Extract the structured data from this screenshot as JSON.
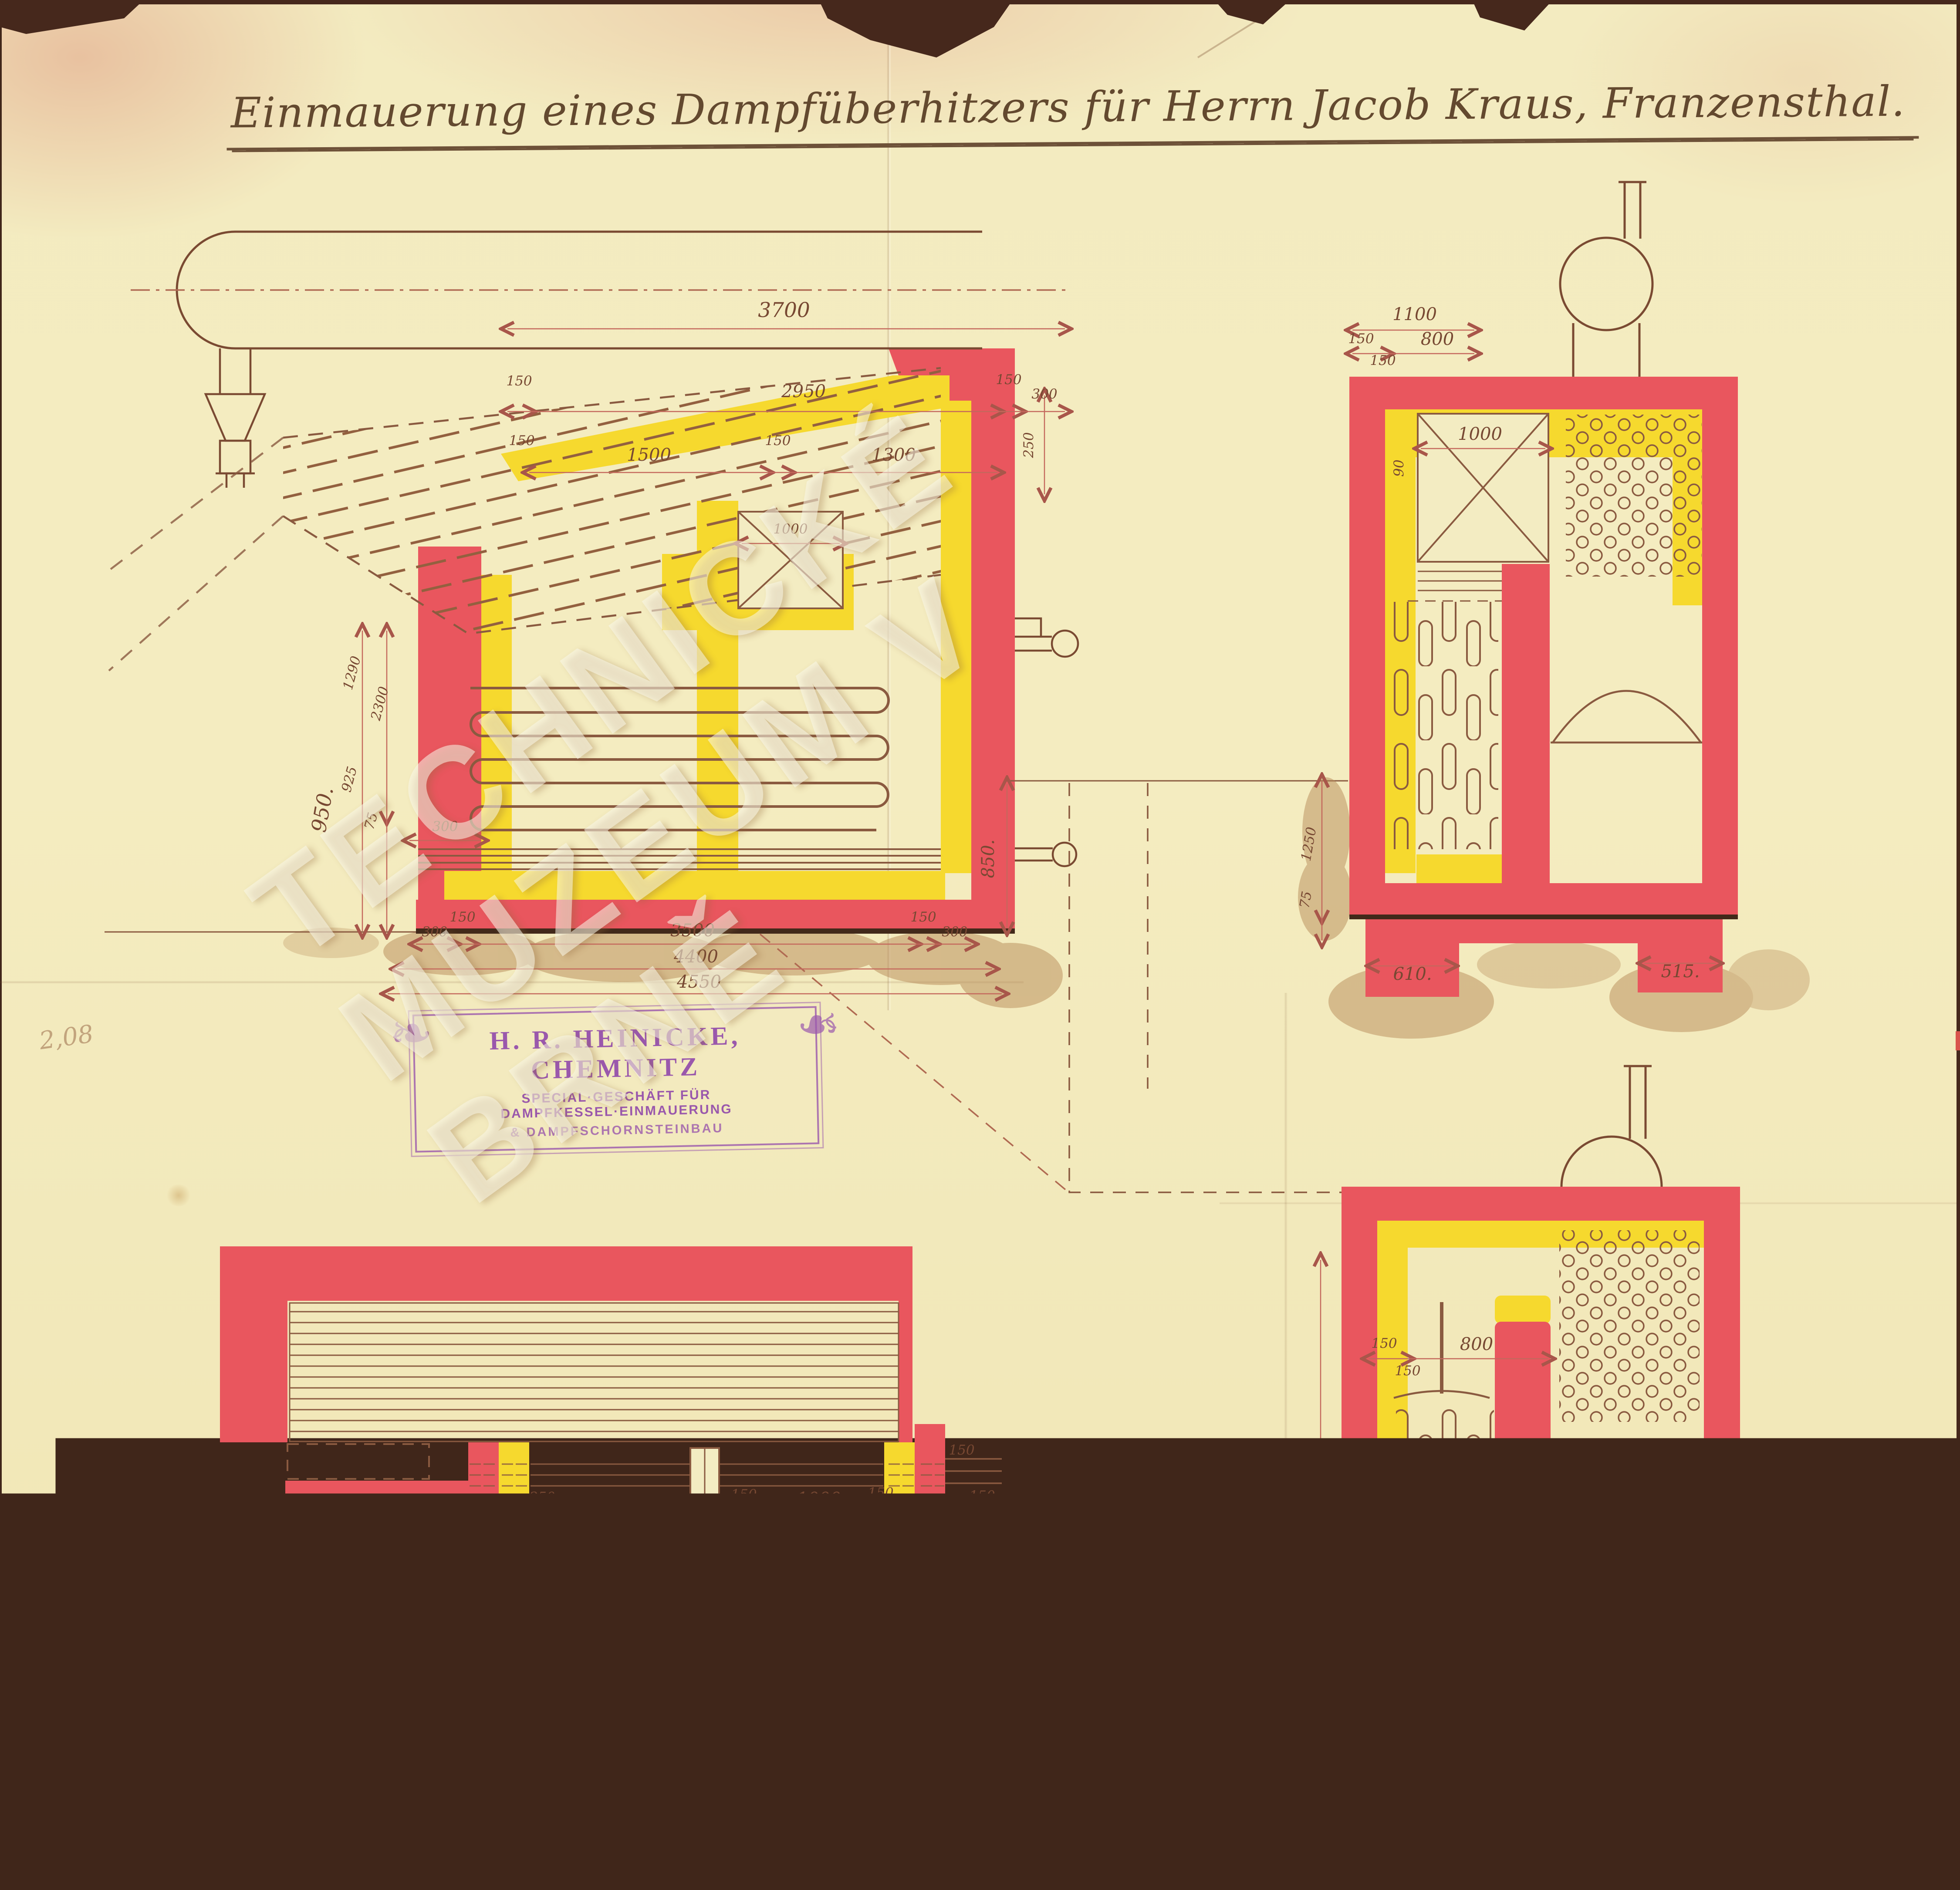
{
  "sheet": {
    "title": "Einmauerung eines Dampfüberhitzers für Herrn Jacob Kraus, Franzensthal.",
    "pencil_note": "2,08",
    "watermark": "TECHNICKÉ MUZEUM V BRNĚ"
  },
  "stamp": {
    "line1": "H. R. HEINICKE, CHEMNITZ",
    "line2": "SPECIAL·GESCHÄFT FÜR DAMPFKESSEL·EINMAUERUNG",
    "line3": "& DAMPFSCHORNSTEINBAU"
  },
  "scalebar": {
    "label": "Maßstab 1:30.",
    "ticks": [
      "1,0",
      "0",
      "1",
      "2",
      "3",
      "4 m."
    ]
  },
  "marks": {
    "file_number": "J№ 4534/8 2",
    "inventory": "979",
    "inventory_suffix": "s"
  },
  "colors": {
    "masonry_red": "#e9565e",
    "firebrick_yellow": "#f6d92e",
    "ink_brown": "#7a4a32",
    "dimension_red": "#c4685c",
    "stamp_violet": "#9a58ac",
    "crayon_red": "#df5a3d",
    "paper": "#f2e9bd"
  },
  "views": {
    "side": {
      "t3700": "3700",
      "t2950": "2950",
      "t150a": "150",
      "t150b": "150",
      "t150c": "150",
      "t1500": "1500",
      "t150d": "150",
      "t1300": "1300",
      "t300": "300",
      "i1000": "1000",
      "r250": "250",
      "r850": "850.",
      "l1290": "1290",
      "l2300": "2300",
      "l925": "925",
      "l950": "950.",
      "l75": "75",
      "w300": "300",
      "b300a": "300",
      "b150a": "150",
      "b3500": "3500",
      "b150b": "150",
      "b300b": "300",
      "b4400": "4400",
      "b4550": "4550"
    },
    "front": {
      "t1100": "1100",
      "t800": "800",
      "t150a": "150",
      "t150b": "150",
      "i1000": "1000",
      "i90": "90",
      "l1250": "1250",
      "l75": "75",
      "f610": "610.",
      "f515": "515."
    },
    "plan": {
      "i250": "250",
      "i1000a": "1000",
      "i50": "50",
      "i150a": "150",
      "i1000b": "1000",
      "i150b": "150",
      "r150a": "150",
      "r150b": "150",
      "v1100": "1100",
      "v800": "800",
      "v150a": "150",
      "v150b": "150",
      "b1500": "1500",
      "b150a": "150",
      "b1300": "1300",
      "b150b": "150",
      "b300": "300",
      "l150a": "150",
      "l150b": "150",
      "b2950": "2950",
      "b3700": "3700",
      "b4400": "4400"
    },
    "rear": {
      "t150a": "150",
      "t150b": "150",
      "t800": "800",
      "l2300": "2300",
      "l75": "75"
    }
  }
}
